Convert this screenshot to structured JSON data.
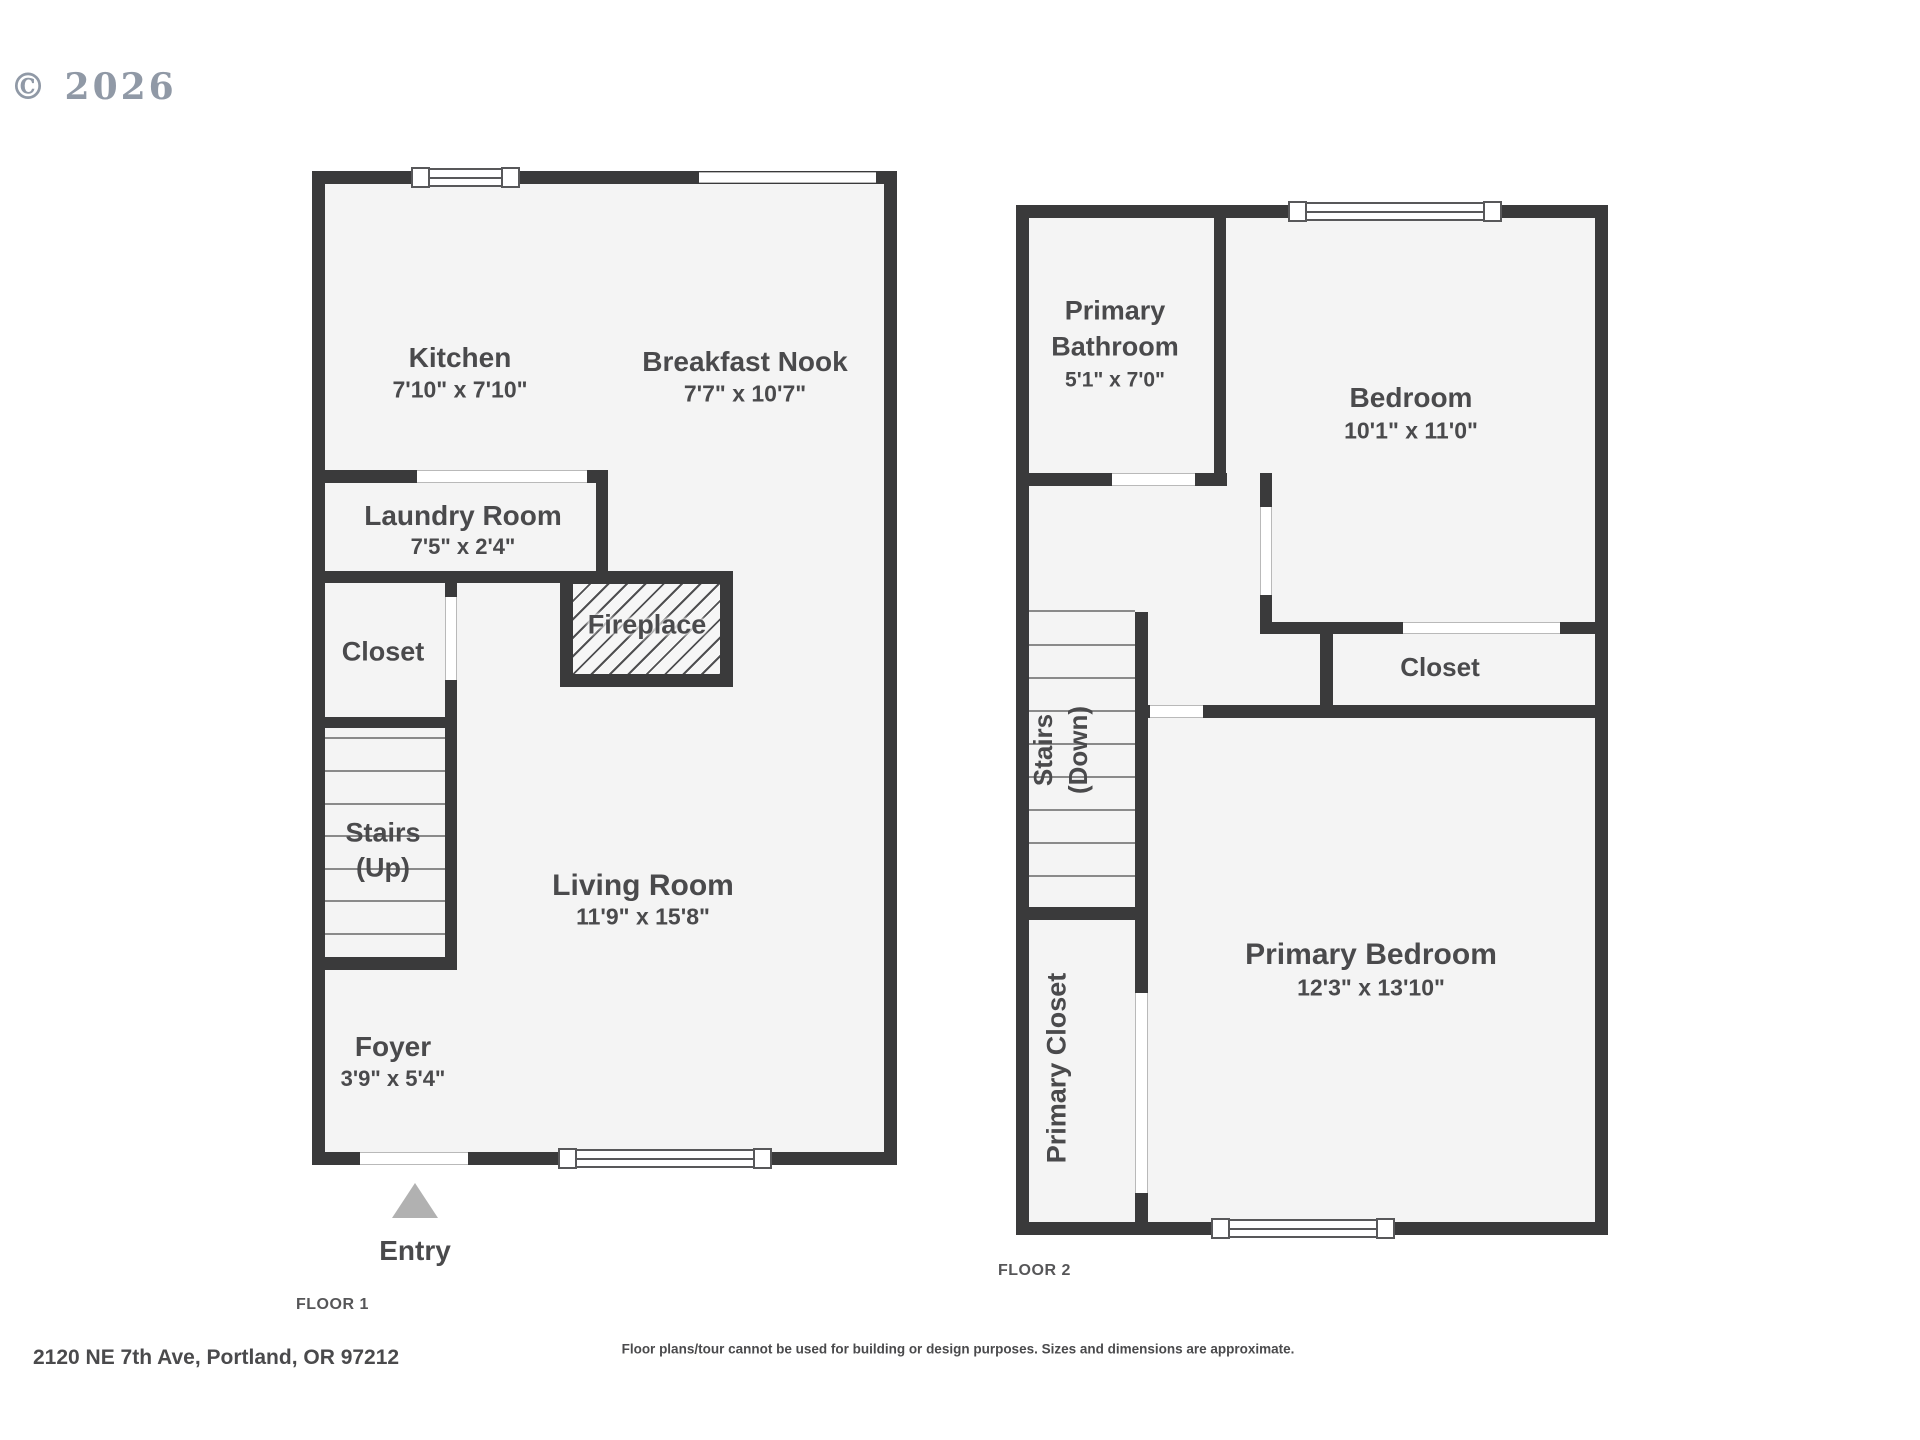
{
  "copyright": "© 2026",
  "floor1": {
    "label": "FLOOR 1",
    "kitchen": {
      "name": "Kitchen",
      "dims": "7'10\" x 7'10\""
    },
    "nook": {
      "name": "Breakfast Nook",
      "dims": "7'7\" x 10'7\""
    },
    "laundry": {
      "name": "Laundry Room",
      "dims": "7'5\" x 2'4\""
    },
    "closet": {
      "name": "Closet"
    },
    "fireplace": {
      "name": "Fireplace"
    },
    "stairs": {
      "line1": "Stairs",
      "line2": "(Up)"
    },
    "living": {
      "name": "Living Room",
      "dims": "11'9\" x 15'8\""
    },
    "foyer": {
      "name": "Foyer",
      "dims": "3'9\" x 5'4\""
    },
    "entry": {
      "label": "Entry"
    }
  },
  "floor2": {
    "label": "FLOOR 2",
    "bathroom": {
      "line1": "Primary",
      "line2": "Bathroom",
      "dims": "5'1\" x 7'0\""
    },
    "bedroom": {
      "name": "Bedroom",
      "dims": "10'1\" x 11'0\""
    },
    "closet": {
      "name": "Closet"
    },
    "stairs": {
      "line1": "Stairs",
      "line2": "(Down)"
    },
    "primary_closet": {
      "name": "Primary Closet"
    },
    "primary_bedroom": {
      "name": "Primary Bedroom",
      "dims": "12'3\" x 13'10\""
    }
  },
  "footer": {
    "address": "2120 NE 7th Ave, Portland, OR 97212",
    "disclaimer": "Floor plans/tour cannot be used for building or design purposes. Sizes and dimensions are approximate."
  },
  "colors": {
    "wall": "#3a3a3b",
    "floor_fill": "#f4f4f4",
    "label_text": "#4a4a4c",
    "entry_arrow": "#b1b1b1",
    "copyright_text": "#9099a6"
  }
}
